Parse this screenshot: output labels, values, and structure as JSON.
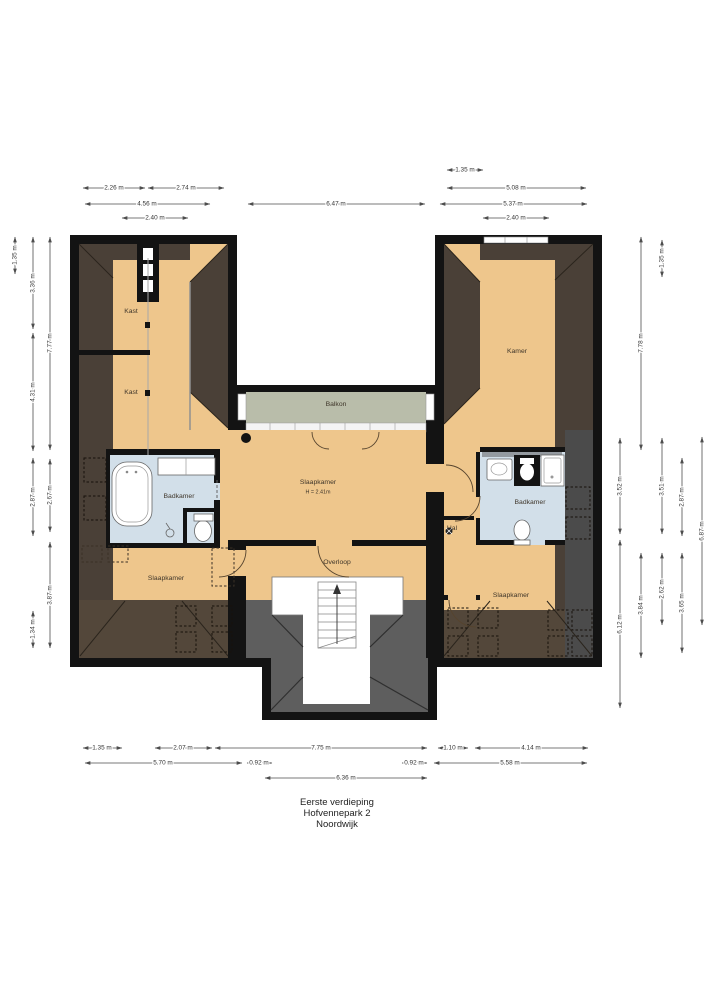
{
  "title": {
    "line1": "Eerste verdieping",
    "line2": "Hofvennepark 2",
    "line3": "Noordwijk"
  },
  "rooms": {
    "kast_top": "Kast",
    "kast_mid": "Kast",
    "kamer": "Kamer",
    "balkon": "Balkon",
    "slaapkamer_center": "Slaapkamer",
    "slaapkamer_center_h": "H = 2.41m",
    "badkamer_left": "Badkamer",
    "badkamer_right": "Badkamer",
    "hal": "Hal",
    "overloop": "Overloop",
    "slaapkamer_left": "Slaapkamer",
    "slaapkamer_right": "Slaapkamer"
  },
  "dimensions": {
    "top": [
      "2.26 m",
      "2.74 m",
      "4.56 m",
      "2.40 m",
      "6.47 m",
      "1.35 m",
      "5.08 m",
      "5.37 m",
      "2.40 m"
    ],
    "left": [
      "1.35 m",
      "3.36 m",
      "7.77 m",
      "4.31 m",
      "2.87 m",
      "2.67 m",
      "3.87 m",
      "1.34 m"
    ],
    "right": [
      "7.78 m",
      "1.35 m",
      "3.52 m",
      "3.51 m",
      "2.87 m",
      "6.87 m",
      "6.12 m",
      "3.84 m",
      "2.62 m",
      "3.65 m"
    ],
    "bottom": [
      "1.35 m",
      "2.07 m",
      "7.75 m",
      "1.10 m",
      "4.14 m",
      "5.70 m",
      "0.92 m",
      "0.92 m",
      "5.58 m",
      "6.36 m"
    ]
  },
  "colors": {
    "wall": "#131313",
    "floor": "#eec68c",
    "roof_dark": "#4a4037",
    "roof_light": "#53473a",
    "roof_gray": "#5e5e5e",
    "bathroom": "#d2dfe9",
    "balcony": "#b9bdaa"
  }
}
